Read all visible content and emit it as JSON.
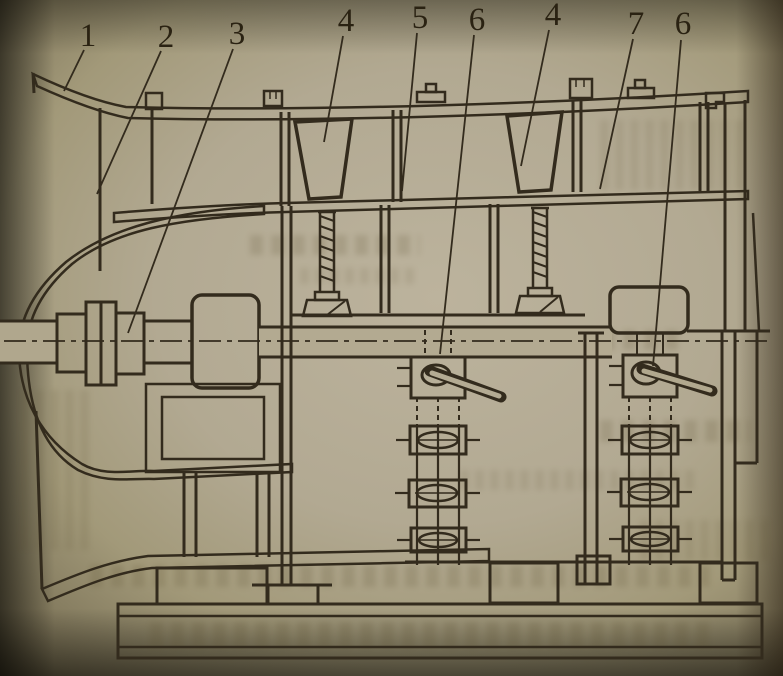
{
  "figure": {
    "callouts": [
      {
        "label": "1"
      },
      {
        "label": "2"
      },
      {
        "label": "3"
      },
      {
        "label": "4"
      },
      {
        "label": "5"
      },
      {
        "label": "6"
      },
      {
        "label": "4"
      },
      {
        "label": "7"
      },
      {
        "label": "6"
      }
    ]
  },
  "palette": {
    "paper": "#b2a98f",
    "ink": "#332b1d",
    "page_shadow": "#2a2517"
  }
}
